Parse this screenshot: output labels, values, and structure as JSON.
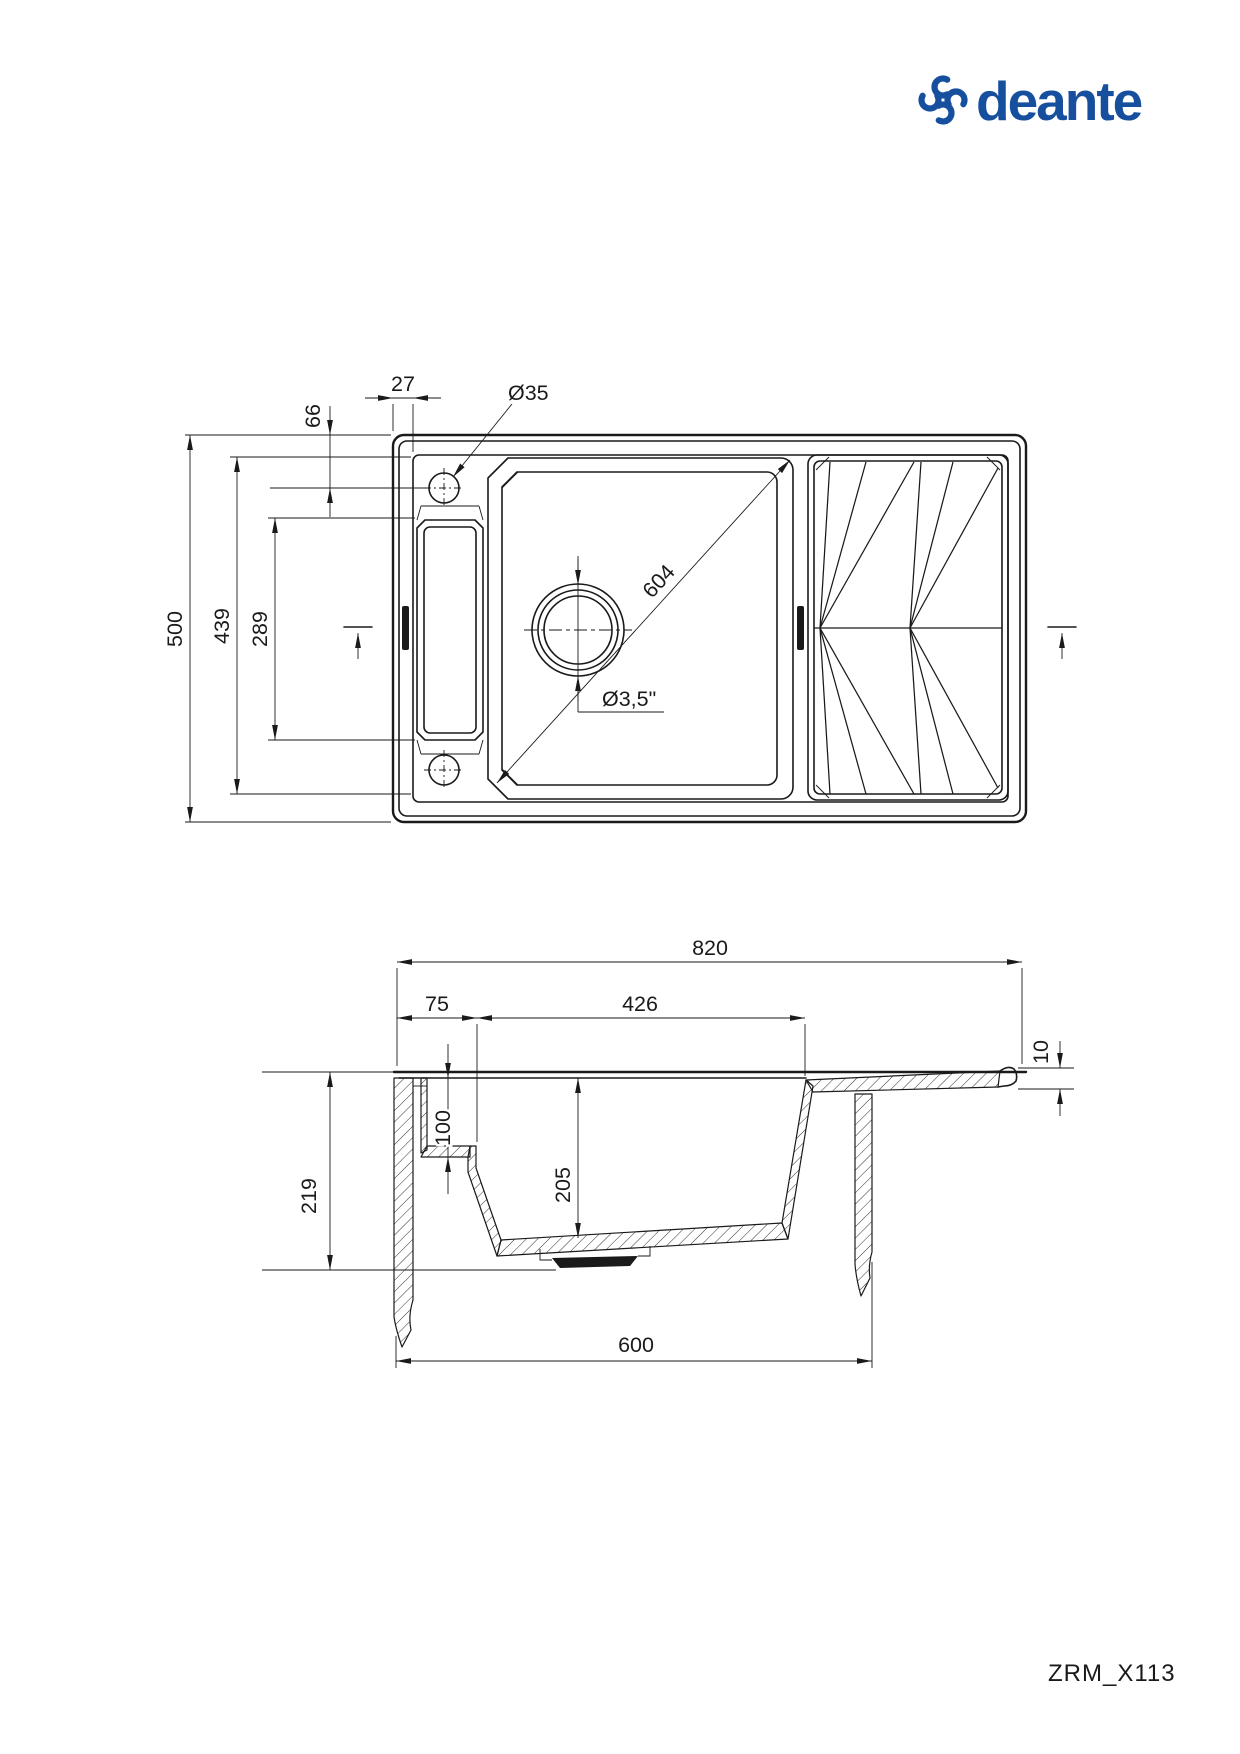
{
  "brand": {
    "name": "deante",
    "logo_color": "#164F9E"
  },
  "colors": {
    "background": "#ffffff",
    "line": "#1a1a1a",
    "logo_blue": "#164F9E"
  },
  "model_code": "ZRM_X113",
  "top_view": {
    "dims": {
      "rim_width": "27",
      "hole_offset": "66",
      "hole_diameter": "Ø35",
      "overall_depth": "500",
      "inner_depth": "439",
      "channel_length": "289",
      "bowl_diagonal": "604",
      "drain_diameter": "Ø3,5\""
    }
  },
  "section_view": {
    "dims": {
      "overall_width": "820",
      "rim_width": "75",
      "bowl_opening": "426",
      "board_thickness": "10",
      "overall_height": "219",
      "ledge_depth": "100",
      "bowl_depth": "205",
      "cabinet_width": "600"
    }
  }
}
